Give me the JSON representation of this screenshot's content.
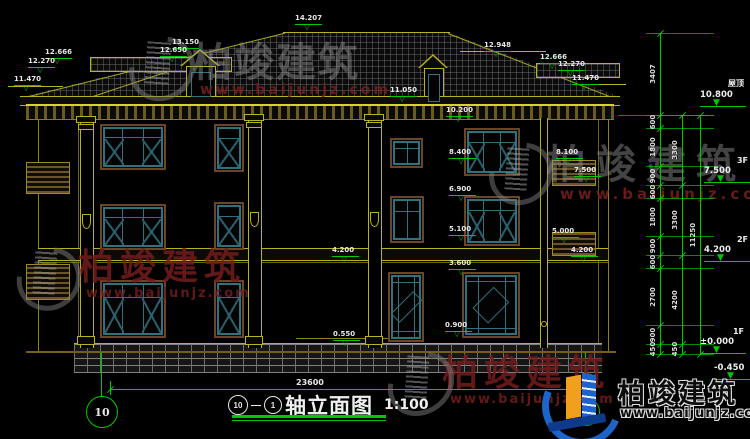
{
  "title_block": {
    "axis_from": "10",
    "dash": "—",
    "axis_to": "1",
    "title": "轴立面图",
    "scale": "1:100"
  },
  "overall_dimension": "23600",
  "axis_bubbles": {
    "left": "10",
    "right": "1"
  },
  "level_markers": [
    {
      "label": "14.207",
      "x": 295,
      "y": 15
    },
    {
      "label": "13.150",
      "x": 172,
      "y": 39
    },
    {
      "label": "12.650",
      "x": 160,
      "y": 47
    },
    {
      "label": "12.666",
      "x": 45,
      "y": 49
    },
    {
      "label": "12.270",
      "x": 28,
      "y": 58
    },
    {
      "label": "11.470",
      "x": 14,
      "y": 76
    },
    {
      "label": "12.948",
      "x": 484,
      "y": 42
    },
    {
      "label": "12.666",
      "x": 540,
      "y": 54
    },
    {
      "label": "12.270",
      "x": 558,
      "y": 61
    },
    {
      "label": "11.470",
      "x": 572,
      "y": 75
    },
    {
      "label": "11.050",
      "x": 390,
      "y": 87
    },
    {
      "label": "10.200",
      "x": 446,
      "y": 107
    },
    {
      "label": "8.400",
      "x": 449,
      "y": 149
    },
    {
      "label": "8.100",
      "x": 556,
      "y": 149
    },
    {
      "label": "7.500",
      "x": 574,
      "y": 167
    },
    {
      "label": "6.900",
      "x": 449,
      "y": 186
    },
    {
      "label": "5.100",
      "x": 449,
      "y": 226
    },
    {
      "label": "5.000",
      "x": 552,
      "y": 228
    },
    {
      "label": "4.200",
      "x": 332,
      "y": 247
    },
    {
      "label": "4.200",
      "x": 571,
      "y": 247
    },
    {
      "label": "3.600",
      "x": 449,
      "y": 260
    },
    {
      "label": "0.900",
      "x": 445,
      "y": 322
    },
    {
      "label": "0.550",
      "x": 333,
      "y": 331
    }
  ],
  "right_levels": [
    {
      "name": "屋顶",
      "value": "10.800"
    },
    {
      "name": "3F",
      "value": "7.500"
    },
    {
      "name": "2F",
      "value": "4.200"
    },
    {
      "name": "1F",
      "value": "±0.000"
    },
    {
      "name": "",
      "value": "-0.450"
    }
  ],
  "dimension_chains": [
    {
      "id": "inner",
      "values": [
        "3407",
        "600",
        "1800",
        "900",
        "600",
        "1800",
        "900",
        "600",
        "2700",
        "900",
        "450"
      ]
    },
    {
      "id": "middle",
      "values": [
        "3300",
        "3300",
        "4200",
        "450"
      ]
    },
    {
      "id": "outer",
      "values": [
        "11250"
      ]
    }
  ],
  "watermarks": {
    "brand": "柏竣建筑",
    "url": "www.baijunjz.com"
  },
  "footer_logo": {
    "brand": "柏竣建筑",
    "url": "www.baijunjz.com"
  },
  "colors": {
    "line_yellow": "#b9b31f",
    "line_green": "#00c800",
    "window_teal": "#2e7280",
    "frame_brown": "#6b4526",
    "watermark_red": "#6b1d1d",
    "text_white": "#e8e8e8",
    "logo_blue": "#1c64c8",
    "logo_orange": "#f0a01c"
  }
}
